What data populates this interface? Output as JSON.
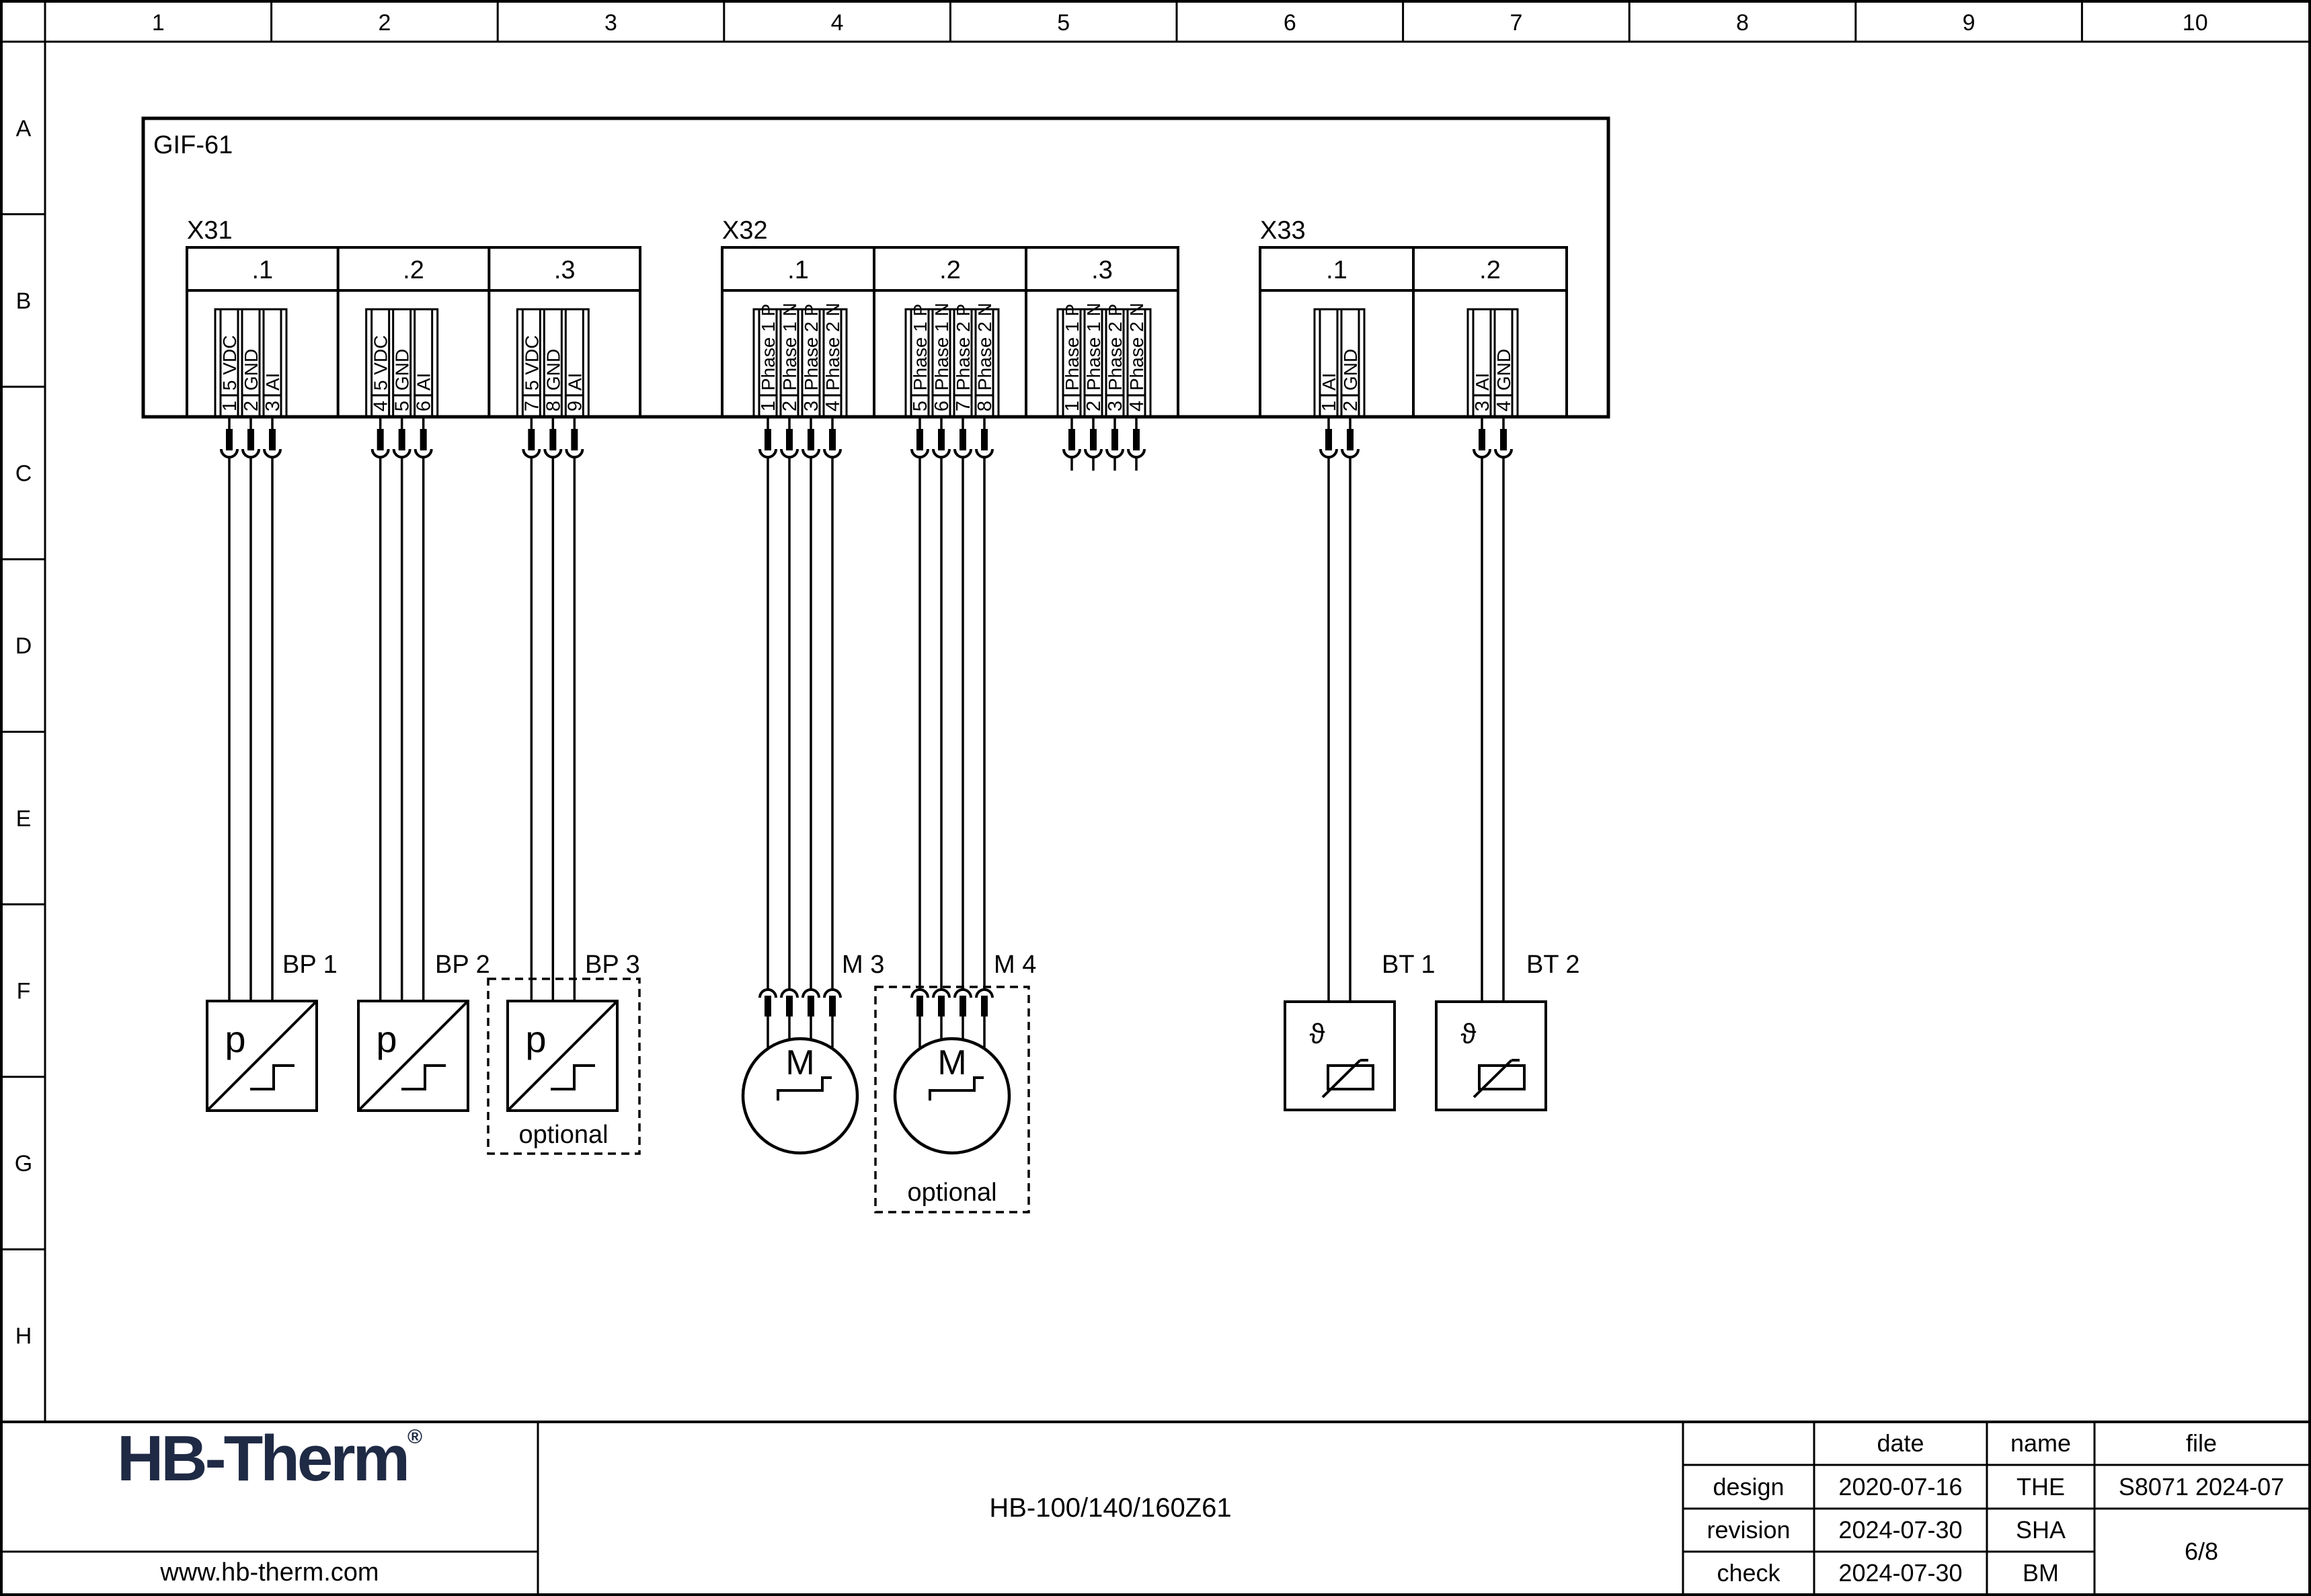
{
  "sheet": {
    "rulers": {
      "columns": [
        "1",
        "2",
        "3",
        "4",
        "5",
        "6",
        "7",
        "8",
        "9",
        "10"
      ],
      "rows": [
        "A",
        "B",
        "C",
        "D",
        "E",
        "F",
        "G",
        "H"
      ]
    }
  },
  "diagram": {
    "module_label": "GIF-61",
    "optional_label": "optional",
    "connectors": [
      {
        "id": "X31",
        "label": "X31",
        "sections": [
          {
            "name": ".1",
            "pins": [
              {
                "no": "1",
                "label": "5 VDC"
              },
              {
                "no": "2",
                "label": "GND"
              },
              {
                "no": "3",
                "label": "AI"
              }
            ]
          },
          {
            "name": ".2",
            "pins": [
              {
                "no": "4",
                "label": "5 VDC"
              },
              {
                "no": "5",
                "label": "GND"
              },
              {
                "no": "6",
                "label": "AI"
              }
            ]
          },
          {
            "name": ".3",
            "pins": [
              {
                "no": "7",
                "label": "5 VDC"
              },
              {
                "no": "8",
                "label": "GND"
              },
              {
                "no": "9",
                "label": "AI"
              }
            ]
          }
        ]
      },
      {
        "id": "X32",
        "label": "X32",
        "sections": [
          {
            "name": ".1",
            "pins": [
              {
                "no": "1",
                "label": "Phase 1 P"
              },
              {
                "no": "2",
                "label": "Phase 1 N"
              },
              {
                "no": "3",
                "label": "Phase 2 P"
              },
              {
                "no": "4",
                "label": "Phase 2 N"
              }
            ]
          },
          {
            "name": ".2",
            "pins": [
              {
                "no": "5",
                "label": "Phase 1 P"
              },
              {
                "no": "6",
                "label": "Phase 1 N"
              },
              {
                "no": "7",
                "label": "Phase 2 P"
              },
              {
                "no": "8",
                "label": "Phase 2 N"
              }
            ]
          },
          {
            "name": ".3",
            "pins": [
              {
                "no": "1",
                "label": "Phase 1 P"
              },
              {
                "no": "2",
                "label": "Phase 1 N"
              },
              {
                "no": "3",
                "label": "Phase 2 P"
              },
              {
                "no": "4",
                "label": "Phase 2 N"
              }
            ]
          }
        ]
      },
      {
        "id": "X33",
        "label": "X33",
        "sections": [
          {
            "name": ".1",
            "pins": [
              {
                "no": "1",
                "label": "AI"
              },
              {
                "no": "2",
                "label": "GND"
              }
            ]
          },
          {
            "name": ".2",
            "pins": [
              {
                "no": "3",
                "label": "AI"
              },
              {
                "no": "4",
                "label": "GND"
              }
            ]
          }
        ]
      }
    ],
    "devices": [
      {
        "id": "BP1",
        "label": "BP 1",
        "type": "pressure-sensor",
        "symbol": "p",
        "optional": false
      },
      {
        "id": "BP2",
        "label": "BP 2",
        "type": "pressure-sensor",
        "symbol": "p",
        "optional": false
      },
      {
        "id": "BP3",
        "label": "BP 3",
        "type": "pressure-sensor",
        "symbol": "p",
        "optional": true
      },
      {
        "id": "M3",
        "label": "M 3",
        "type": "motor",
        "symbol": "M",
        "optional": false
      },
      {
        "id": "M4",
        "label": "M 4",
        "type": "motor",
        "symbol": "M",
        "optional": true
      },
      {
        "id": "BT1",
        "label": "BT 1",
        "type": "temperature-sensor",
        "symbol": "ϑ",
        "optional": false
      },
      {
        "id": "BT2",
        "label": "BT 2",
        "type": "temperature-sensor",
        "symbol": "ϑ",
        "optional": false
      }
    ]
  },
  "title_block": {
    "logo_text": "HB-Therm",
    "logo_reg": "®",
    "logo_color": "#1f2a44",
    "website": "www.hb-therm.com",
    "document_title": "HB-100/140/160Z61",
    "table": {
      "headers": {
        "date": "date",
        "name": "name",
        "file": "file"
      },
      "rows": [
        {
          "label": "design",
          "date": "2020-07-16",
          "name": "THE"
        },
        {
          "label": "revision",
          "date": "2024-07-30",
          "name": "SHA"
        },
        {
          "label": "check",
          "date": "2024-07-30",
          "name": "BM"
        }
      ],
      "file_value": "S8071 2024-07",
      "page": "6/8"
    }
  }
}
